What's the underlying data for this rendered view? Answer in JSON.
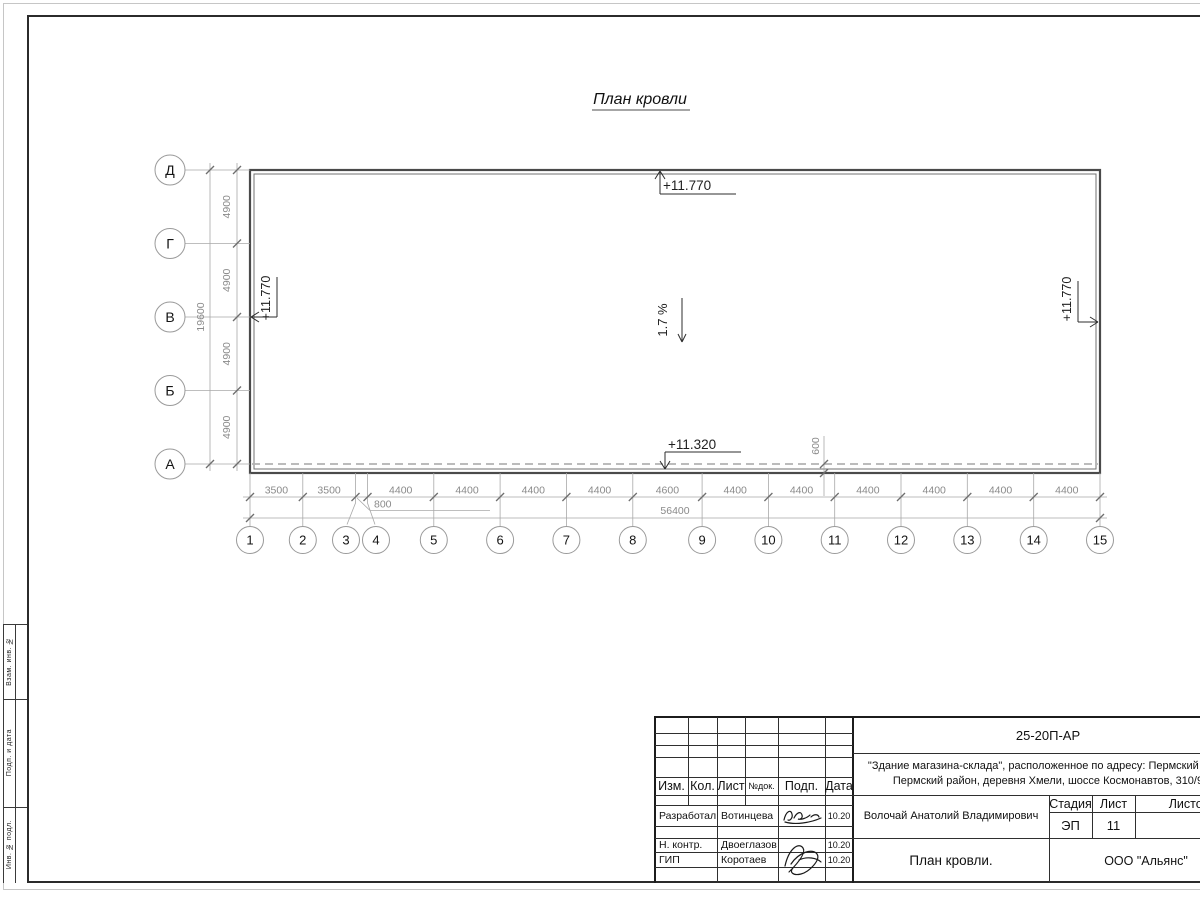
{
  "plan": {
    "title": "План кровли",
    "row_axes": [
      "Д",
      "Г",
      "В",
      "Б",
      "А"
    ],
    "col_axes": [
      "1",
      "2",
      "3",
      "4",
      "5",
      "6",
      "7",
      "8",
      "9",
      "10",
      "11",
      "12",
      "13",
      "14",
      "15"
    ],
    "dims_bottom": [
      "3500",
      "3500",
      "800",
      "4400",
      "4400",
      "4400",
      "4400",
      "4600",
      "4400",
      "4400",
      "4400",
      "4400",
      "4400",
      "4400"
    ],
    "total_bottom": "56400",
    "dims_left": [
      "4900",
      "4900",
      "4900",
      "4900"
    ],
    "total_left": "19600",
    "offset_dim": "600",
    "elev_top": "+11.770",
    "elev_left": "+11.770",
    "elev_right": "+11.770",
    "elev_bottom": "+11.320",
    "slope": "1.7 %"
  },
  "side_stamp": {
    "cells": [
      "Взам. инв. №",
      "Подп. и дата",
      "Инв. № подл."
    ]
  },
  "title_block": {
    "doc_code": "25-20П-АР",
    "project_line1": "\"Здание магазина-склада\", расположенное по адресу: Пермский край,",
    "project_line2": "Пермский район, деревня Хмели, шоссе Космонавтов, 310/9",
    "col_headers": [
      "Изм.",
      "Кол.",
      "Лист",
      "№док.",
      "Подп.",
      "Дата"
    ],
    "signers": [
      {
        "role": "Разработал",
        "name": "Вотинцева",
        "date": "10.20"
      },
      {
        "role": "Н. контр.",
        "name": "Двоеглазов",
        "date": "10.20"
      },
      {
        "role": "ГИП",
        "name": "Коротаев",
        "date": "10.20"
      }
    ],
    "approver": "Волочай Анатолий Владимирович",
    "stage_label": "Стадия",
    "sheet_label": "Лист",
    "sheets_label": "Листов",
    "stage_value": "ЭП",
    "sheet_value": "11",
    "sheets_value": "",
    "drawing_name": "План кровли.",
    "company": "ООО \"Альянс\""
  }
}
